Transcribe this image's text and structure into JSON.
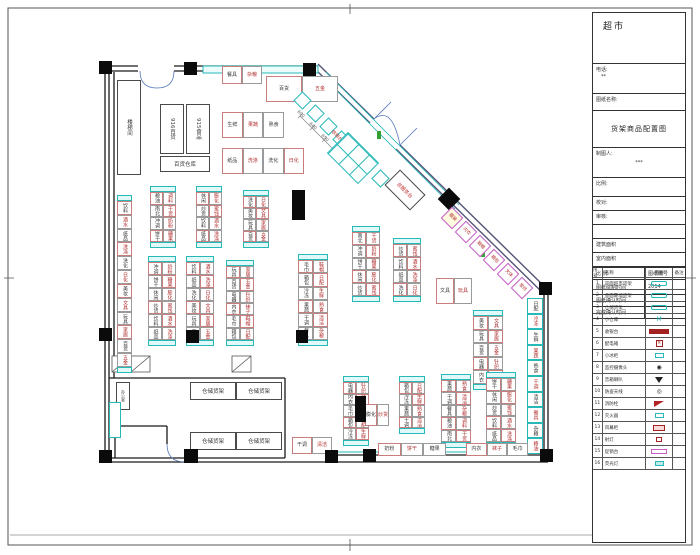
{
  "sheet": {
    "title": "超市",
    "phone_label": "电话:",
    "phone_value": "**",
    "name_label": "图纸名称:",
    "drawing_title": "货架商品配置图",
    "drafter_label": "制图人:",
    "drafter_value": "***",
    "fields": [
      "比例:",
      "校对:",
      "审核:",
      "",
      "建筑面积",
      "室内面积"
    ],
    "legend": {
      "headers": [
        "序号",
        "名称",
        "图例",
        "备注"
      ],
      "rows": [
        {
          "no": "1",
          "name": "双面超市货架",
          "sym": "cyanbox"
        },
        {
          "no": "2",
          "name": "单面靠墙货架",
          "sym": "cyanbox"
        },
        {
          "no": "3",
          "name": "仓储货架",
          "sym": "cyanbox"
        },
        {
          "no": "4",
          "name": "小仓库",
          "sym": "msym"
        },
        {
          "no": "5",
          "name": "收银台",
          "sym": "redbar"
        },
        {
          "no": "6",
          "name": "配电箱",
          "sym": "redx"
        },
        {
          "no": "7",
          "name": "小冰柜",
          "sym": "cyansm"
        },
        {
          "no": "8",
          "name": "监控摄像头",
          "sym": "cam"
        },
        {
          "no": "9",
          "name": "音箱喇叭",
          "sym": "tri"
        },
        {
          "no": "10",
          "name": "防盗天线",
          "sym": "circ"
        },
        {
          "no": "11",
          "name": "消防栓",
          "sym": "flag"
        },
        {
          "no": "12",
          "name": "灭火器",
          "sym": "cyansm"
        },
        {
          "no": "13",
          "name": "风幕柜",
          "sym": "redbox"
        },
        {
          "no": "14",
          "name": "射灯",
          "sym": "redsm"
        },
        {
          "no": "15",
          "name": "促销台",
          "sym": "magbox"
        },
        {
          "no": "16",
          "name": "荧光灯",
          "sym": "cyanfill"
        }
      ]
    },
    "footer_rows": [
      [
        "比 例",
        "图纸编号"
      ],
      [
        "图纸绘制时间",
        "2014"
      ],
      [
        "图纸确认时间",
        ""
      ],
      [
        "完成确认时间",
        ""
      ]
    ]
  },
  "plan": {
    "label_pool": [
      "粮油",
      "调料",
      "南北",
      "干货",
      "冲调",
      "奶粉",
      "饼干",
      "糖果",
      "休闲",
      "膨化",
      "炒货",
      "蜜饯",
      "饮料",
      "酒水",
      "纸品",
      "洗涤",
      "洗化",
      "日化",
      "美妆",
      "文具",
      "玩具",
      "家居",
      "百货",
      "五金",
      "电器",
      "针织",
      "内衣",
      "袜子",
      "毛巾",
      "鞋帽",
      "箱包",
      "日配",
      "冷冻",
      "生鲜",
      "果蔬",
      "熟食",
      "干调",
      "清洁",
      "餐具",
      "杂粮"
    ],
    "runs": [
      {
        "x": 150,
        "y": 186,
        "w": 26,
        "h": 62,
        "rows": 4,
        "cols": 2,
        "cap": true,
        "li": 0
      },
      {
        "x": 196,
        "y": 186,
        "w": 26,
        "h": 62,
        "rows": 4,
        "cols": 2,
        "cap": true,
        "li": 8
      },
      {
        "x": 243,
        "y": 190,
        "w": 26,
        "h": 58,
        "rows": 4,
        "cols": 2,
        "cap": true,
        "li": 16
      },
      {
        "x": 148,
        "y": 256,
        "w": 28,
        "h": 90,
        "rows": 6,
        "cols": 2,
        "cap": true,
        "li": 4
      },
      {
        "x": 186,
        "y": 256,
        "w": 28,
        "h": 90,
        "rows": 6,
        "cols": 2,
        "cap": true,
        "li": 12
      },
      {
        "x": 226,
        "y": 260,
        "w": 28,
        "h": 86,
        "rows": 6,
        "cols": 2,
        "cap": true,
        "li": 20
      },
      {
        "x": 298,
        "y": 254,
        "w": 30,
        "h": 92,
        "rows": 6,
        "cols": 2,
        "cap": true,
        "li": 28
      },
      {
        "x": 352,
        "y": 226,
        "w": 28,
        "h": 76,
        "rows": 5,
        "cols": 2,
        "cap": true,
        "li": 2
      },
      {
        "x": 393,
        "y": 238,
        "w": 28,
        "h": 64,
        "rows": 4,
        "cols": 2,
        "cap": true,
        "li": 10
      },
      {
        "x": 473,
        "y": 310,
        "w": 30,
        "h": 80,
        "rows": 5,
        "cols": 2,
        "cap": true,
        "li": 18
      },
      {
        "x": 343,
        "y": 376,
        "w": 26,
        "h": 70,
        "rows": 5,
        "cols": 2,
        "cap": true,
        "li": 24
      },
      {
        "x": 399,
        "y": 376,
        "w": 26,
        "h": 58,
        "rows": 4,
        "cols": 2,
        "cap": true,
        "li": 30
      },
      {
        "x": 441,
        "y": 374,
        "w": 30,
        "h": 74,
        "rows": 5,
        "cols": 2,
        "cap": true,
        "li": 34
      },
      {
        "x": 486,
        "y": 372,
        "w": 30,
        "h": 76,
        "rows": 5,
        "cols": 2,
        "cap": true,
        "li": 6
      },
      {
        "x": 117,
        "y": 195,
        "w": 15,
        "h": 178,
        "rows": 12,
        "cols": 1,
        "cap": true,
        "li": 12
      },
      {
        "x": 527,
        "y": 298,
        "w": 16,
        "h": 156,
        "rows": 10,
        "cols": 1,
        "cyan": true,
        "li": 31
      },
      {
        "x": 266,
        "y": 76,
        "w": 72,
        "h": 26,
        "rows": 1,
        "cols": 2,
        "horiz": true,
        "li": 22
      },
      {
        "x": 222,
        "y": 112,
        "w": 62,
        "h": 26,
        "rows": 1,
        "cols": 3,
        "horiz": true,
        "li": 33
      },
      {
        "x": 222,
        "y": 148,
        "w": 82,
        "h": 26,
        "rows": 1,
        "cols": 4,
        "horiz": true,
        "li": 14
      },
      {
        "x": 222,
        "y": 66,
        "w": 40,
        "h": 18,
        "rows": 1,
        "cols": 2,
        "horiz": true,
        "li": 38
      },
      {
        "x": 378,
        "y": 443,
        "w": 68,
        "h": 13,
        "rows": 1,
        "cols": 3,
        "horiz": true,
        "li": 5
      },
      {
        "x": 466,
        "y": 443,
        "w": 62,
        "h": 13,
        "rows": 1,
        "cols": 3,
        "horiz": true,
        "li": 26
      },
      {
        "x": 292,
        "y": 437,
        "w": 40,
        "h": 17,
        "rows": 1,
        "cols": 2,
        "horiz": true,
        "li": 36
      },
      {
        "x": 436,
        "y": 278,
        "w": 36,
        "h": 26,
        "rows": 1,
        "cols": 2,
        "horiz": true,
        "li": 19
      },
      {
        "x": 365,
        "y": 404,
        "w": 24,
        "h": 22,
        "rows": 1,
        "cols": 2,
        "horiz": true,
        "li": 9
      }
    ],
    "boxes": [
      {
        "x": 117,
        "y": 80,
        "w": 24,
        "h": 95,
        "t": "楼梯间",
        "vert": true
      },
      {
        "x": 160,
        "y": 104,
        "w": 24,
        "h": 50,
        "t": "916百货",
        "vert": true
      },
      {
        "x": 186,
        "y": 104,
        "w": 24,
        "h": 50,
        "t": "915食品",
        "vert": true
      },
      {
        "x": 160,
        "y": 156,
        "w": 50,
        "h": 16,
        "t": "百货仓库"
      },
      {
        "x": 190,
        "y": 382,
        "w": 46,
        "h": 18,
        "t": "仓储货架"
      },
      {
        "x": 236,
        "y": 382,
        "w": 46,
        "h": 18,
        "t": "仓储货架"
      },
      {
        "x": 190,
        "y": 432,
        "w": 46,
        "h": 18,
        "t": "仓储货架"
      },
      {
        "x": 236,
        "y": 432,
        "w": 46,
        "h": 18,
        "t": "仓储货架"
      },
      {
        "x": 116,
        "y": 382,
        "w": 14,
        "h": 28,
        "t": "办公室",
        "vert": true,
        "fs": 4
      },
      {
        "x": 109,
        "y": 402,
        "w": 12,
        "h": 36,
        "t": "",
        "bc": "#27b8b8"
      }
    ],
    "columns": [
      [
        99,
        61,
        13,
        13
      ],
      [
        184,
        62,
        13,
        13
      ],
      [
        303,
        63,
        13,
        13
      ],
      [
        99,
        328,
        13,
        13
      ],
      [
        99,
        450,
        13,
        13
      ],
      [
        184,
        449,
        14,
        14
      ],
      [
        325,
        450,
        13,
        13
      ],
      [
        363,
        449,
        13,
        13
      ],
      [
        540,
        449,
        13,
        13
      ],
      [
        539,
        282,
        13,
        13
      ],
      [
        296,
        330,
        12,
        13
      ],
      [
        186,
        330,
        13,
        13
      ],
      [
        292,
        190,
        13,
        30
      ],
      [
        355,
        396,
        11,
        26
      ]
    ],
    "diamonds": [
      [
        441,
        191,
        16
      ]
    ],
    "diag_squares": [
      [
        302,
        100
      ],
      [
        315,
        113
      ],
      [
        328,
        126
      ],
      [
        341,
        139
      ],
      [
        354,
        152
      ],
      [
        367,
        165
      ],
      [
        380,
        178
      ]
    ],
    "mag_cells": [
      {
        "x": 452,
        "y": 218,
        "t": "服装",
        "bg": "#fffbe0"
      },
      {
        "x": 466,
        "y": 232,
        "t": "内衣"
      },
      {
        "x": 480,
        "y": 246,
        "t": "鞋帽"
      },
      {
        "x": 494,
        "y": 260,
        "t": "箱包"
      },
      {
        "x": 508,
        "y": 274,
        "t": "文体"
      },
      {
        "x": 522,
        "y": 288,
        "t": "家纺"
      }
    ],
    "dims": [
      {
        "x": 296,
        "y": 112,
        "t": "690"
      },
      {
        "x": 308,
        "y": 124,
        "t": "640"
      },
      {
        "x": 320,
        "y": 136,
        "t": "650"
      },
      {
        "x": 332,
        "y": 148,
        "t": "760"
      },
      {
        "x": 344,
        "y": 160,
        "t": "3400"
      }
    ],
    "rot_texts": [
      {
        "x": 330,
        "y": 133,
        "t": "收银台"
      }
    ],
    "service_desk": {
      "x": 387,
      "y": 179,
      "w": 36,
      "h": 22,
      "t": "总服务台"
    },
    "checkout_bank": {
      "x": 331,
      "y": 143,
      "w": 44,
      "h": 30
    }
  }
}
